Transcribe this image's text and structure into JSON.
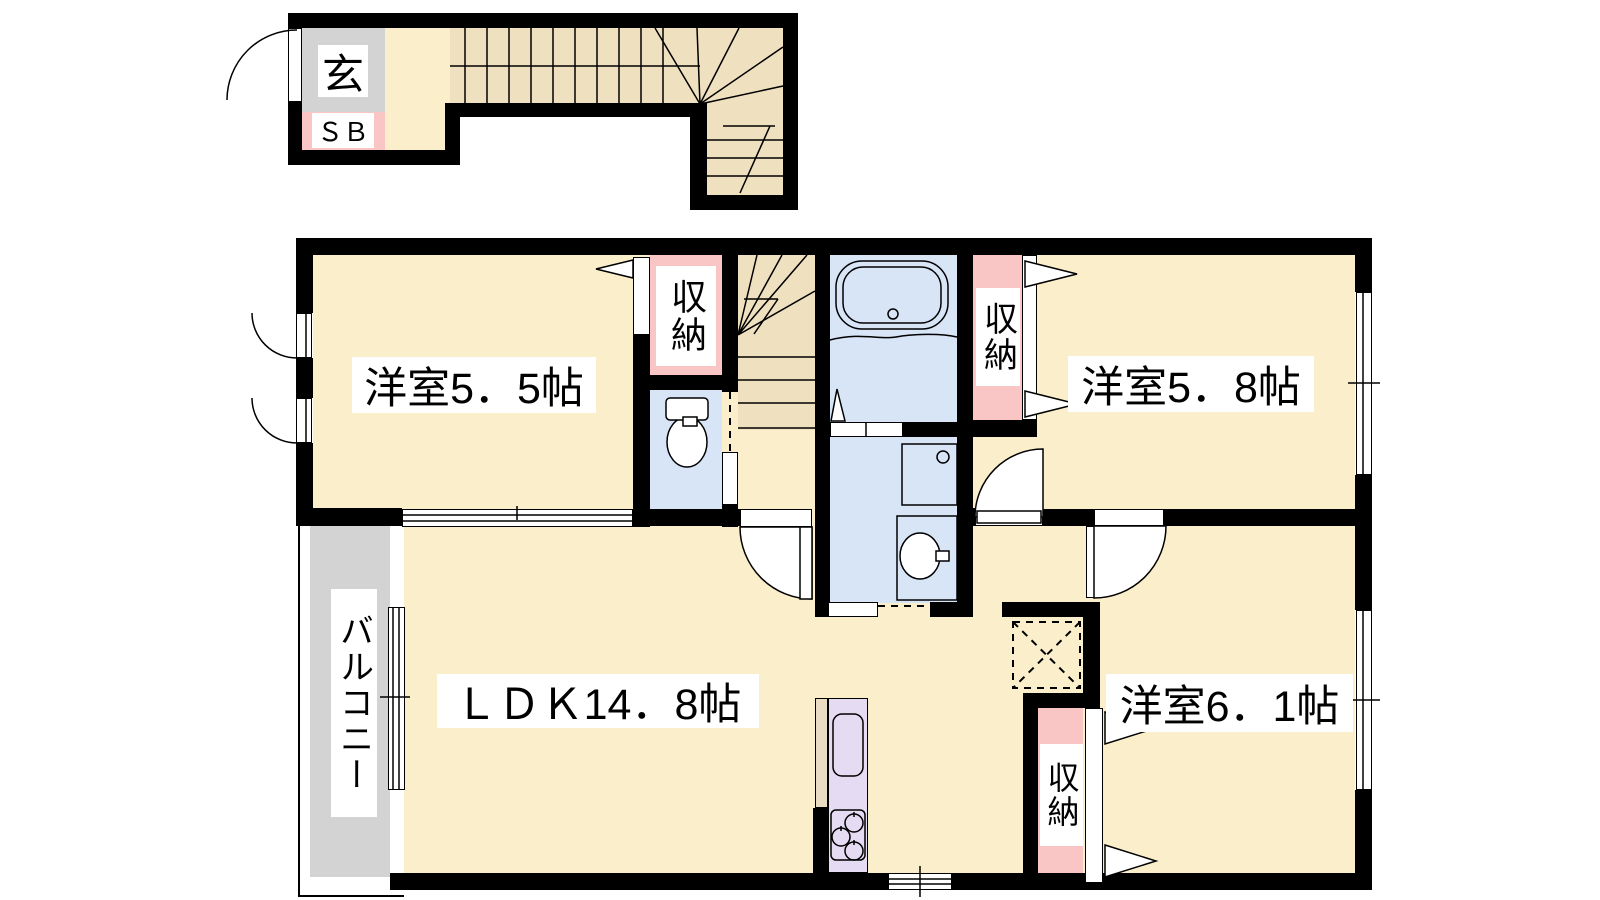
{
  "plan": {
    "type": "apartment-floor-plan",
    "entrance": {
      "label": "玄"
    },
    "shoe_box": {
      "label": "ＳＢ"
    },
    "rooms": {
      "western_5_5": {
        "label": "洋室5．5帖"
      },
      "western_5_8": {
        "label": "洋室5．8帖"
      },
      "western_6_1": {
        "label": "洋室6．1帖"
      },
      "ldk": {
        "label": "ＬＤＫ14．8帖"
      },
      "balcony": {
        "label": "バルコニー"
      }
    },
    "closets": {
      "closet_5_5": {
        "label": "収納"
      },
      "closet_5_8": {
        "label": "収納"
      },
      "closet_6_1": {
        "label": "収納"
      }
    },
    "colors": {
      "wall": "#000000",
      "floor_cream": "#fbefcb",
      "stair_tan": "#efe0bf",
      "closet_pink": "#f9c6c5",
      "wet_area_blue": "#d7e5f7",
      "kitchen_purple": "#e5dbf2",
      "balcony_gray": "#d3d3d3"
    }
  }
}
